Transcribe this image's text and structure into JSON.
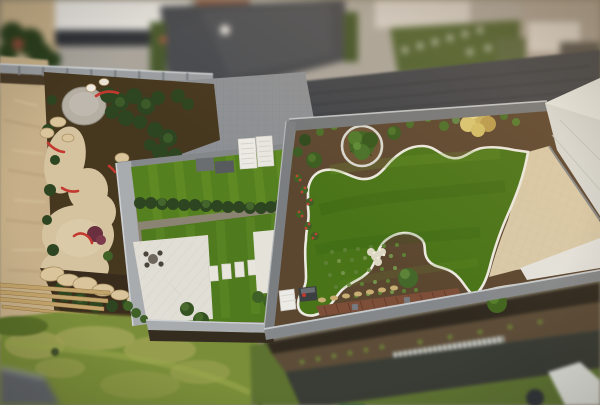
{
  "scene": {
    "type": "aerial-drone-photo",
    "description": "Tilt-shift aerial view of modern landscaped rooftop gardens: sandy construction strip at left, gravel garden with round stone circle and red edging arcs, central artificial lawn terrace with white patio, stepping stones and slatted canopy furniture, and a large rooftop lawn with curvy white-edged mulch planting beds, circular tree planter, round shrubs, beige stone path and white roofs at right, meadow grass and drainage channel along the bottom, blurred houses and driveway at top.",
    "regions": [
      "top-buildings",
      "driveway",
      "brick-wall",
      "fence",
      "gray-paving",
      "left-garden",
      "gravel-circle",
      "sand-paths",
      "red-edging",
      "boulders",
      "wood-planks",
      "center-garden",
      "upper-lawn",
      "hedge",
      "terrace",
      "stepping-stones",
      "canopy",
      "roof-garden",
      "roof-lawn",
      "mulch-beds",
      "tree-planter",
      "yellow-shrub",
      "kidney-bed",
      "brick-strip",
      "beige-path",
      "white-roof",
      "meadow",
      "drainage-grate",
      "service-strip"
    ]
  },
  "colors": {
    "sand": "#c7b089",
    "sandPath": "#d5c3a0",
    "soil": "#46371f",
    "mulch": "#5b4630",
    "gravelCircle": "#b5afa3",
    "stone": "#d9c49c",
    "plank": "#c2a36b",
    "bushDark": "#2d4520",
    "bushMid": "#3f6126",
    "lawnUpper": "#55801f",
    "lawnLower": "#4f7a1e",
    "lawnRoof": "#497418",
    "meadow": "#7a8e39",
    "meadowPatch": "#a3a557",
    "edging": "#ebe9e0",
    "parapet": "#74777a",
    "borderLight": "#a9acaf",
    "pavingGray": "#8d9094",
    "terrace": "#e0ded5",
    "slab": "#e7e5dc",
    "canopy": "#eceae4",
    "boxGray": "#6b6e71",
    "beigePath": "#d8c9a8",
    "roofWhite": "#d6d8d4",
    "brickStrip": "#7d4e38",
    "redEdging": "#c4392f",
    "yellowFrame": "#d8a43c",
    "flowersRed": "#c04433",
    "flowersWhite": "#ddd8c4",
    "shrubYellow": "#c9b25f",
    "driveway": "#46494e",
    "wallBrick": "#41444a",
    "fence": "#9a9ea1",
    "buildingWhite": "#e7e5e1",
    "buildingBrick": "#94573f",
    "buildingOrange": "#b05a2e",
    "roofDark": "#2f3237",
    "soilBand": "#5c4c38",
    "asphalt": "#3f423c",
    "grassDark": "#5d7230",
    "teal": "#2c5a50",
    "drain": "#e8e8e2",
    "shadowBand": "#30291f",
    "wallBlur": "#61656a"
  }
}
